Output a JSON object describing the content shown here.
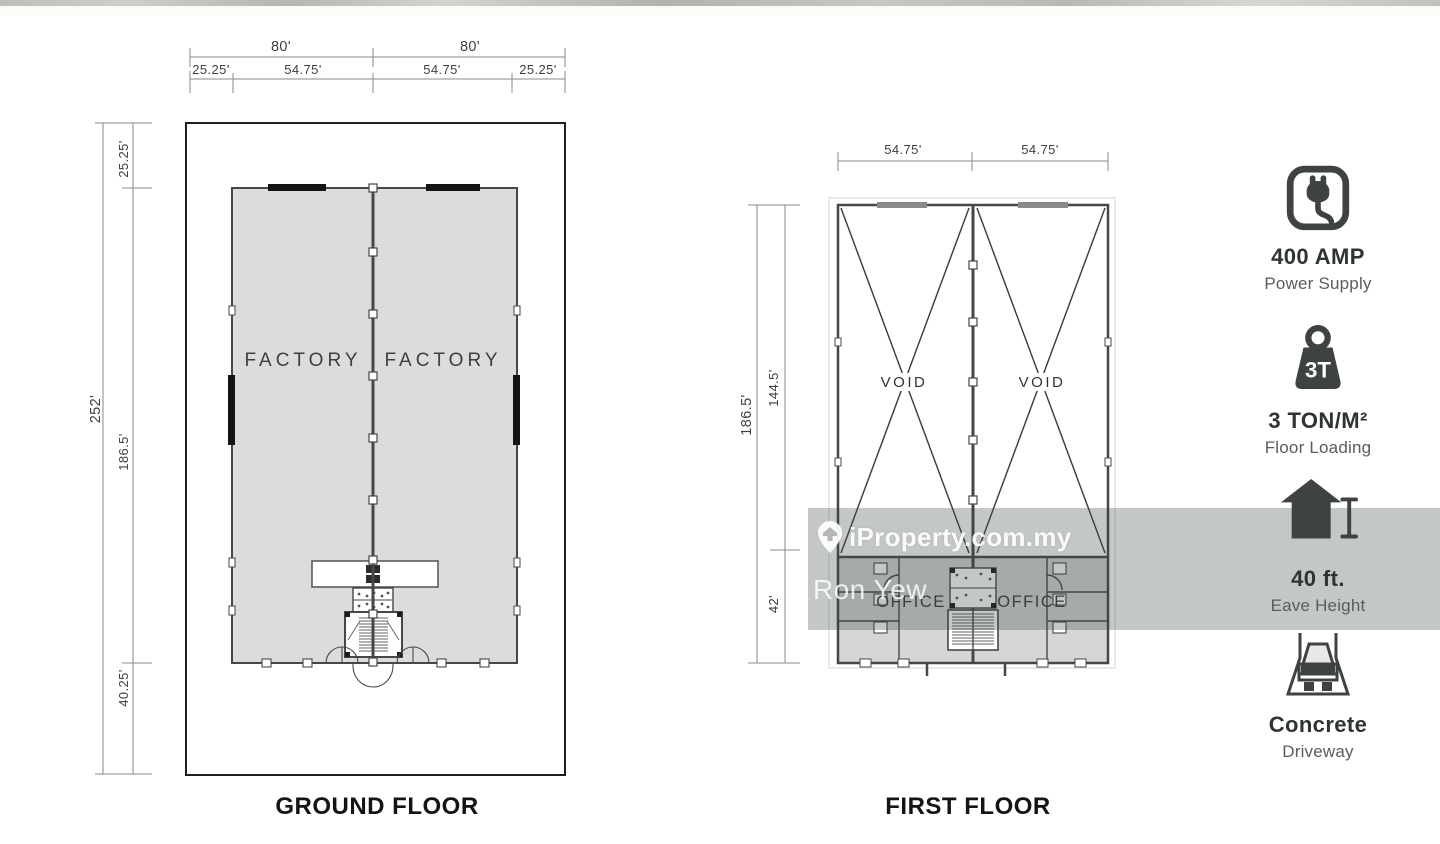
{
  "watermark": {
    "brand": "iProperty.com.my",
    "agent": "Ron Yew"
  },
  "ground_floor": {
    "title": "GROUND FLOOR",
    "room_labels": [
      "FACTORY",
      "FACTORY"
    ],
    "dim_top_row1": [
      "80'",
      "80'"
    ],
    "dim_top_row2": [
      "25.25'",
      "54.75'",
      "54.75'",
      "25.25'"
    ],
    "dim_left_total": "252'",
    "dim_left_segments": [
      "25.25'",
      "186.5'",
      "40.25'"
    ]
  },
  "first_floor": {
    "title": "FIRST FLOOR",
    "void_labels": [
      "VOID",
      "VOID"
    ],
    "office_labels": [
      "OFFICE",
      "OFFICE"
    ],
    "dim_top": [
      "54.75'",
      "54.75'"
    ],
    "dim_left_total": "186.5'",
    "dim_left_segments": [
      "144.5'",
      "42'"
    ]
  },
  "features": [
    {
      "icon": "power-plug-icon",
      "value": "400 AMP",
      "label": "Power Supply"
    },
    {
      "icon": "weight-3t-icon",
      "value": "3 TON/M²",
      "label": "Floor Loading",
      "icon_text": "3T"
    },
    {
      "icon": "eave-height-icon",
      "value": "40 ft.",
      "label": "Eave Height"
    },
    {
      "icon": "truck-driveway-icon",
      "value": "Concrete",
      "label": "Driveway"
    }
  ],
  "colors": {
    "plan_fill": "#dcdcdc",
    "wall_line": "#474747",
    "icon_dark": "#3e4243",
    "watermark_overlay": "rgba(60,70,70,0.30)"
  }
}
